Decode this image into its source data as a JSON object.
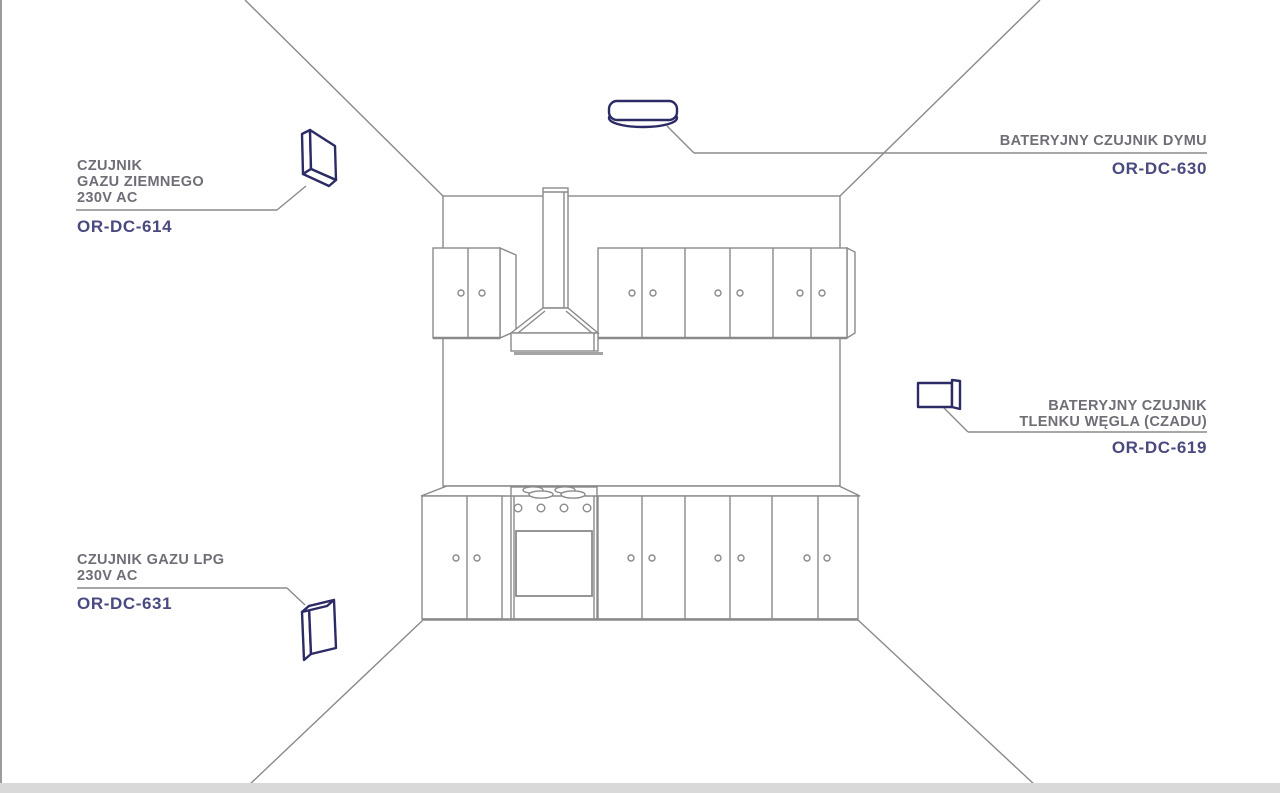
{
  "sensors": {
    "natural_gas": {
      "name_line1": "CZUJNIK",
      "name_line2": "GAZU ZIEMNEGO",
      "voltage": "230V AC",
      "code": "OR-DC-614"
    },
    "smoke": {
      "name_line1": "BATERYJNY CZUJNIK DYMU",
      "code": "OR-DC-630"
    },
    "carbon_monoxide": {
      "name_line1": "BATERYJNY CZUJNIK",
      "name_line2": "TLENKU WĘGLA (CZADU)",
      "code": "OR-DC-619"
    },
    "lpg": {
      "name_line1": "CZUJNIK GAZU LPG",
      "voltage": "230V AC",
      "code": "OR-DC-631"
    }
  },
  "colors": {
    "device_accent": "#2c2b66",
    "code_text": "#4a4a80",
    "label_text": "#6e6e76",
    "drawing_line": "#8a8a8a"
  }
}
